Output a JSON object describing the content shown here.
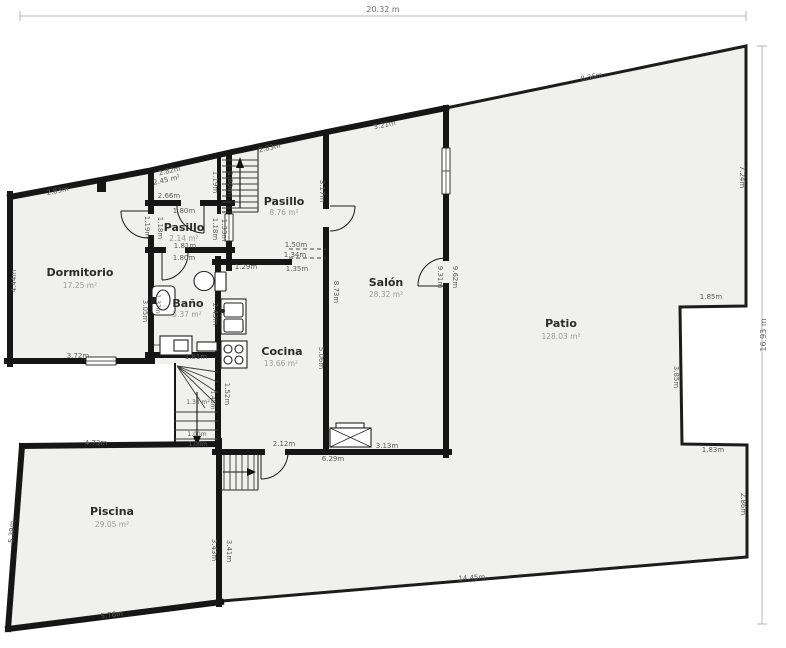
{
  "colors": {
    "background": "#ffffff",
    "wall": "#161616",
    "room_fill": "#f0f0ee",
    "dimension_text": "#5a5a5a"
  },
  "plan": {
    "overall": {
      "width": "20.32 m",
      "height": "16.93 m"
    },
    "rooms": {
      "dormitorio": {
        "name": "Dormitorio",
        "area": "17.25 m²"
      },
      "pasillo_small": {
        "name": "Pasillo",
        "area": "2.14 m²"
      },
      "bano": {
        "name": "Baño",
        "area": "5.37 m²"
      },
      "pasillo_large": {
        "name": "Pasillo",
        "area": "8.76 m²"
      },
      "cocina": {
        "name": "Cocina",
        "area": "13.66 m²"
      },
      "salon": {
        "name": "Salón",
        "area": "28.32 m²"
      },
      "patio": {
        "name": "Patio",
        "area": "128.03 m²"
      },
      "piscina": {
        "name": "Piscina",
        "area": "29.05 m²"
      },
      "stair_room": {
        "area": "2.45 m²"
      },
      "winder_stair": {
        "area": "1.33 m²"
      }
    },
    "dims": {
      "top_total": "20.32 m",
      "right_total": "16.93 m",
      "dorm_top": "2.83m",
      "dorm_left": "4.44m",
      "dorm_bottom": "3.72m",
      "dorm_interior": "3.05m",
      "dorm_door_left": "1.19m",
      "dorm_door_right": "1.18m",
      "stairroom_top": "2.82m",
      "stairroom_side": "1.19m",
      "stair_width": "1.80m",
      "pasillo_small_top": "2.66m",
      "pasillo_small_door": "1.80m",
      "pasillo_small_width": "1.81m",
      "bano_door": "1.80m",
      "passage_left": "1.18m",
      "passage_right": "1.33m",
      "pasillo_large_top": "2.83m",
      "pasillo_large_side": "3.17m",
      "salon_top": "3.21m",
      "salon_side_inner": "9.31m",
      "salon_side_outer": "9.62m",
      "bano_sink_side": "1.37m",
      "bano_bottom": "1.81m",
      "cocina_top": "1.29m",
      "hatch_top": "1.50m",
      "hatch_mid": "1.34m",
      "hatch_bottom": "1.35m",
      "cocina_left": "2.43m",
      "wall_height_full": "8.73m",
      "wall_height_lower": "5.06m",
      "bottom_door": "2.12m",
      "house_bottom": "6.29m",
      "salon_box": "3.13m",
      "winder_inner": "1.45m",
      "winder_side": "1.52m",
      "winder_exit_top": "1.00m",
      "winder_exit_bottom": "1.00m",
      "patio_top": "8.36m",
      "patio_right_upper": "7.24m",
      "notch_top": "1.85m",
      "notch_side": "3.85m",
      "notch_bottom": "1.83m",
      "patio_right_lower": "2.86m",
      "patio_bottom": "14.45m",
      "piscina_top": "4.73m",
      "piscina_left": "5.39m",
      "piscina_bottom": "5.76m",
      "piscina_right_inner": "3.43m",
      "piscina_right_outer": "3.41m"
    }
  }
}
